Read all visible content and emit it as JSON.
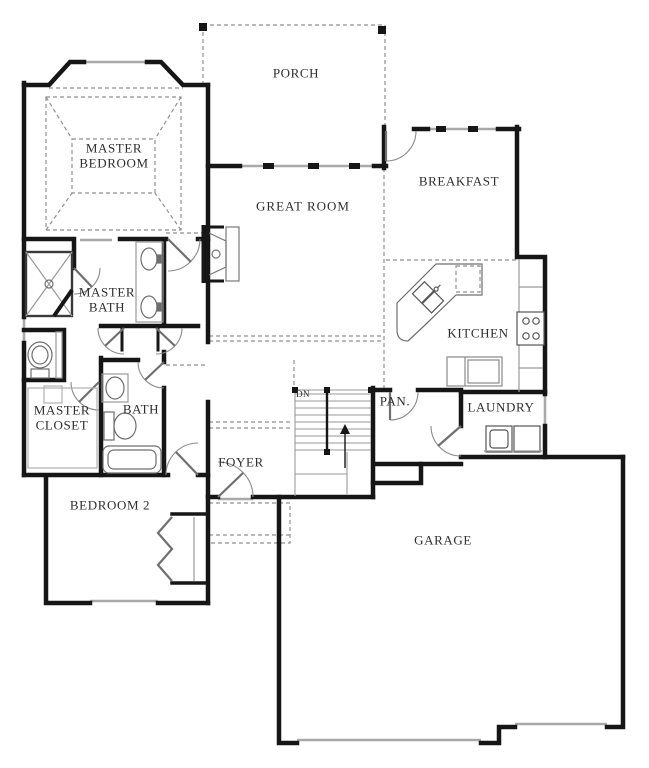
{
  "plan": {
    "type": "residential-floor-plan-first-floor",
    "rooms": [
      {
        "id": "porch",
        "label": "PORCH",
        "x": 296,
        "y": 74
      },
      {
        "id": "master_bedroom",
        "label": "MASTER BEDROOM",
        "x": 114,
        "y": 156
      },
      {
        "id": "great_room",
        "label": "GREAT ROOM",
        "x": 303,
        "y": 207
      },
      {
        "id": "breakfast",
        "label": "BREAKFAST",
        "x": 459,
        "y": 182
      },
      {
        "id": "master_bath",
        "label": "MASTER BATH",
        "x": 107,
        "y": 300
      },
      {
        "id": "kitchen",
        "label": "KITCHEN",
        "x": 478,
        "y": 334
      },
      {
        "id": "master_closet",
        "label": "MASTER CLOSET",
        "x": 62,
        "y": 418
      },
      {
        "id": "bath",
        "label": "BATH",
        "x": 141,
        "y": 410
      },
      {
        "id": "foyer",
        "label": "FOYER",
        "x": 241,
        "y": 463
      },
      {
        "id": "pantry",
        "label": "PAN.",
        "x": 395,
        "y": 402
      },
      {
        "id": "laundry",
        "label": "LAUNDRY",
        "x": 501,
        "y": 408
      },
      {
        "id": "bedroom_2",
        "label": "BEDROOM 2",
        "x": 110,
        "y": 506
      },
      {
        "id": "garage",
        "label": "GARAGE",
        "x": 443,
        "y": 541
      },
      {
        "id": "stairs",
        "label": "DN",
        "x": 303,
        "y": 394
      }
    ],
    "fixtures": [
      "shower",
      "master-toilet",
      "double-vanity-sinks",
      "linen-closets",
      "pedestal-sink",
      "hall-toilet",
      "bathtub",
      "fireplace",
      "kitchen-island-double-sink",
      "dishwasher",
      "range-cooktop",
      "refrigerator",
      "washer",
      "dryer",
      "stairs-down",
      "up-arrow",
      "bedroom2-closet-bifold",
      "front-door",
      "porch-posts",
      "garage-doors"
    ],
    "colors": {
      "wall": "#161616",
      "window": "#a9a9a9",
      "fixture": "#6f6f6f",
      "dashed": "#8f8f8f",
      "text": "#2e2e2e",
      "background": "#ffffff"
    }
  }
}
